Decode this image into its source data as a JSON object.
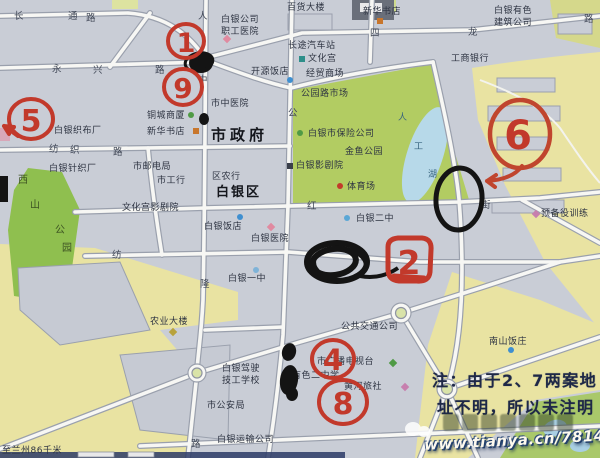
{
  "map": {
    "places": {
      "baihuo": "百货大楼",
      "xinhua_top": "新华书店",
      "youse_jianzhu": "白银有色\n建筑公司",
      "zhigong_yiyuan": "白银公司\n职工医院",
      "changtu": "长途汽车站",
      "wenhuagong": "文化宫",
      "kaiyuan": "开源饭店",
      "jingmao": "经贸商场",
      "gongshang": "工商银行",
      "gongyuanlu_shichang": "公园路市场",
      "shizhongyiyuan": "市中医院",
      "tongcheng": "铜城商厦",
      "xinhua_mid": "新华书店",
      "shizhengfu": "市政府",
      "baoxian": "白银市保险公司",
      "jinyu": "金鱼公园",
      "yingjuyuan": "白银影剧院",
      "tiyuchang": "体育场",
      "zhibuchang": "白银织布厂",
      "zhenzhichang": "白银针织厂",
      "youdianju": "市邮电局",
      "shigonghang": "市工行",
      "qunonghang": "区农行",
      "baiyinqu": "白银区",
      "wenhuagong_yjy": "文化宫影剧院",
      "baiyin_fandian": "白银饭店",
      "baiyin_yiyuan": "白银医院",
      "erzhong": "白银二中",
      "yubeiyi": "预备役训练",
      "yizhong": "白银一中",
      "nongye": "农业大楼",
      "gongjiao": "公共交通公司",
      "nanshan": "南山饭庄",
      "guangbo": "市广播电视台",
      "youse_school": "有色二中学",
      "huanghe": "黄河旅社",
      "jiaxiao": "白银驾驶\n技工学校",
      "gonganju": "市公安局",
      "yunshu": "白银运输公司",
      "lanzhou": "至兰州86千米"
    },
    "streets": {
      "chang": "长",
      "tong": "通",
      "lu1": "路",
      "yong": "永",
      "xing": "兴",
      "lu2": "路",
      "si": "四",
      "long": "龙",
      "lu3": "路",
      "fang": "纺",
      "zhi": "织",
      "lu4": "路",
      "fang2": "纺",
      "hong": "红",
      "jie1": "街",
      "long2": "隆",
      "gong_v": "公",
      "ren": "人",
      "zhong_v": "中",
      "lu5": "路"
    },
    "park_label": {
      "c1": "西",
      "c2": "山",
      "c3": "公",
      "c4": "园"
    },
    "lake_label": {
      "c1": "人",
      "c2": "工",
      "c3": "湖"
    },
    "annotations": {
      "n1": "1",
      "n9": "9",
      "n5": "5",
      "n6": "6",
      "n2": "2",
      "n4": "4",
      "n8": "8"
    },
    "note": {
      "line1": "注：由于2、7两案地",
      "line2": "址不明，所以未注明"
    },
    "watermark_url": "www.tianya.cn/78140653",
    "colors": {
      "annotation_red": "#c2392b",
      "annotation_black": "#141414",
      "urban_gray": "#c9cdd6",
      "field_yellow": "#e9e3a2",
      "park_green": "#b2cc62",
      "lake_blue": "#b7d9e9"
    }
  }
}
